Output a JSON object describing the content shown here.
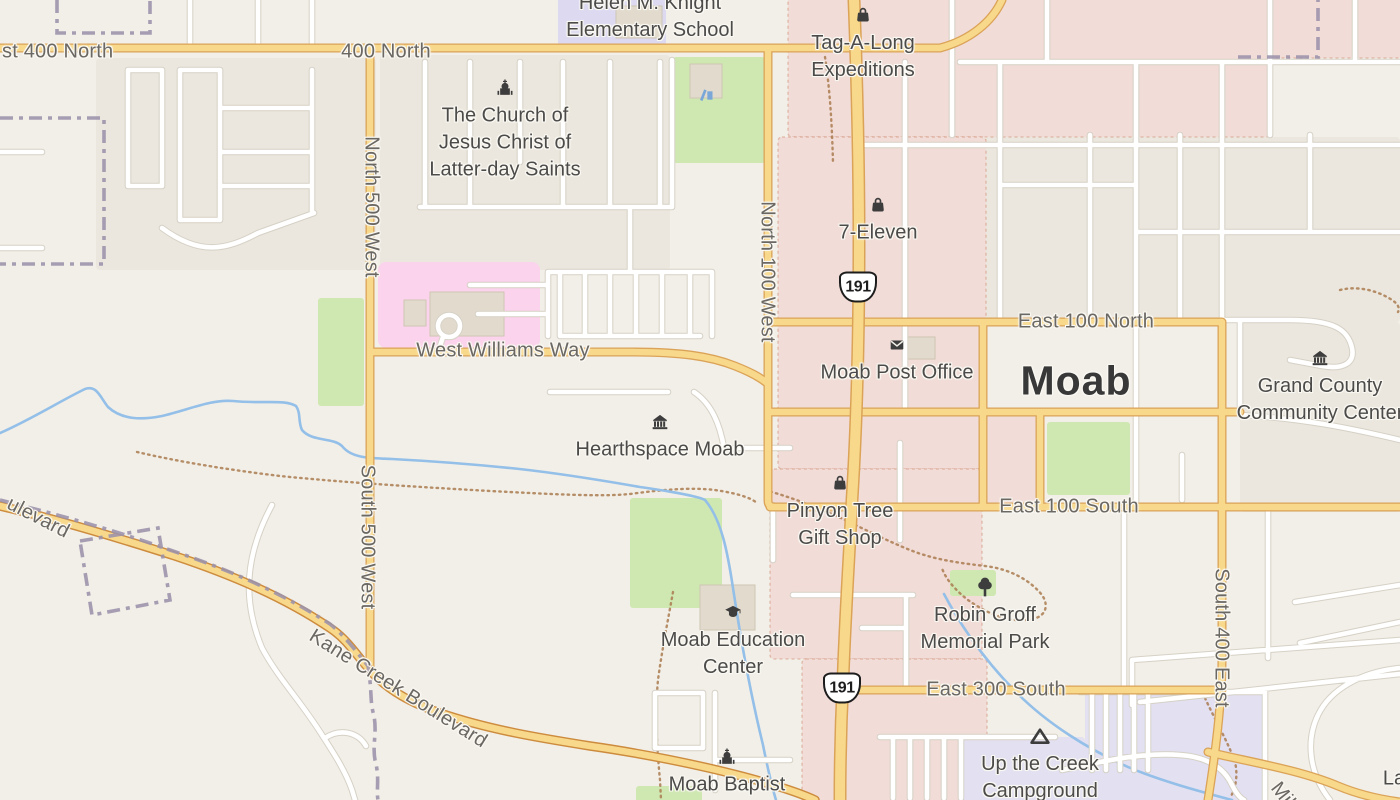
{
  "map": {
    "type": "street-map",
    "city_label": {
      "text": "Moab",
      "x": 1076,
      "y": 381
    },
    "colors": {
      "land": "#f2efe8",
      "residential": "#ebe7de",
      "commercial": "#f1dcd7",
      "commercial_outline": "#cf9076",
      "hospital": "#fbd3ec",
      "school": "#dcd9f1",
      "campground": "#e2e0f1",
      "park": "#cfe8b2",
      "water": "#93bfe8",
      "road_yellow_fill": "#f8d98b",
      "road_yellow_casing": "#dba358",
      "road_orange_casing": "#cd8b3e",
      "road_white_fill": "#ffffff",
      "road_white_casing": "#d6d1c6",
      "boundary": "#9b92ab",
      "trail": "#aa7b50",
      "label_road": "#6b6763",
      "label_poi": "#4c4b4a",
      "city": "#383838",
      "icon": "#3d3d3d",
      "building": "#e2dbcd",
      "building_outline": "#cec4b2",
      "shield_bg": "#ffffff",
      "shield_border": "#1d1d1d",
      "playground": "#7aa7d8"
    },
    "route_shields": [
      {
        "number": "191",
        "x": 858,
        "y": 287
      },
      {
        "number": "191",
        "x": 842,
        "y": 688
      }
    ],
    "street_labels": [
      {
        "id": "east-400-north-partial",
        "text": "st 400 North",
        "x": 2,
        "y": 52,
        "rotate": 0,
        "anchor": "left"
      },
      {
        "id": "400-north",
        "text": "400 North",
        "x": 386,
        "y": 52,
        "rotate": 0
      },
      {
        "id": "east-100-north",
        "text": "East 100 North",
        "x": 1086,
        "y": 322,
        "rotate": 0
      },
      {
        "id": "west-williams-way",
        "text": "West Williams Way",
        "x": 503,
        "y": 351,
        "rotate": 0
      },
      {
        "id": "east-100-south",
        "text": "East 100 South",
        "x": 1069,
        "y": 507,
        "rotate": 0
      },
      {
        "id": "east-300-south",
        "text": "East 300 South",
        "x": 996,
        "y": 690,
        "rotate": 0
      },
      {
        "id": "north-500-west",
        "text": "North 500 West",
        "x": 371,
        "y": 207,
        "rotate": 90
      },
      {
        "id": "south-500-west",
        "text": "South 500 West",
        "x": 367,
        "y": 537,
        "rotate": 90
      },
      {
        "id": "north-100-west",
        "text": "North 100 West",
        "x": 767,
        "y": 272,
        "rotate": 90
      },
      {
        "id": "south-400-east",
        "text": "South 400 East",
        "x": 1221,
        "y": 638,
        "rotate": 90
      },
      {
        "id": "kane-creek-boulevard",
        "text": "Kane Creek Boulevard",
        "x": 398,
        "y": 689,
        "rotate": 32
      },
      {
        "id": "boulevard-partial",
        "text": "ulevard",
        "x": 38,
        "y": 518,
        "rotate": 27
      },
      {
        "id": "mill-partial",
        "text": "Mill",
        "x": 1284,
        "y": 797,
        "rotate": 52
      }
    ],
    "poi_labels": [
      {
        "name": "helen-m-knight-elementary-school",
        "lines": [
          "Helen M. Knight",
          "Elementary School"
        ],
        "x": 650,
        "y": 17,
        "icon": null
      },
      {
        "name": "tag-a-long-expeditions",
        "lines": [
          "Tag-A-Long",
          "Expeditions"
        ],
        "x": 863,
        "y": 57,
        "icon": "shopping-bag-icon"
      },
      {
        "name": "church-of-jesus-christ",
        "lines": [
          "The Church of",
          "Jesus Christ of",
          "Latter-day Saints"
        ],
        "x": 505,
        "y": 143,
        "icon": "church-icon"
      },
      {
        "name": "seven-eleven",
        "lines": [
          "7-Eleven"
        ],
        "x": 878,
        "y": 233,
        "icon": "shopping-bag-icon"
      },
      {
        "name": "moab-post-office",
        "lines": [
          "Moab Post Office"
        ],
        "x": 897,
        "y": 373,
        "icon": "envelope-icon"
      },
      {
        "name": "grand-county-community-center",
        "lines": [
          "Grand County",
          "Community Center"
        ],
        "x": 1320,
        "y": 400,
        "icon": "museum-icon"
      },
      {
        "name": "hearthspace-moab",
        "lines": [
          "Hearthspace Moab"
        ],
        "x": 660,
        "y": 450,
        "icon": "museum-icon"
      },
      {
        "name": "pinyon-tree-gift-shop",
        "lines": [
          "Pinyon Tree",
          "Gift Shop"
        ],
        "x": 840,
        "y": 525,
        "icon": "shopping-bag-icon"
      },
      {
        "name": "moab-education-center",
        "lines": [
          "Moab Education",
          "Center"
        ],
        "x": 733,
        "y": 654,
        "icon": "graduation-cap-icon"
      },
      {
        "name": "robin-groff-memorial-park",
        "lines": [
          "Robin Groff",
          "Memorial Park"
        ],
        "x": 985,
        "y": 629,
        "icon": "tree-icon"
      },
      {
        "name": "up-the-creek-campground",
        "lines": [
          "Up the Creek",
          "Campground"
        ],
        "x": 1040,
        "y": 778,
        "icon": "campsite-icon"
      },
      {
        "name": "moab-baptist",
        "lines": [
          "Moab Baptist"
        ],
        "x": 727,
        "y": 785,
        "icon": "church-icon"
      },
      {
        "name": "la-partial",
        "lines": [
          "La"
        ],
        "x": 1394,
        "y": 779,
        "icon": null
      }
    ],
    "standalone_icons": [
      {
        "icon": "playground-icon",
        "x": 706,
        "y": 94
      }
    ]
  }
}
